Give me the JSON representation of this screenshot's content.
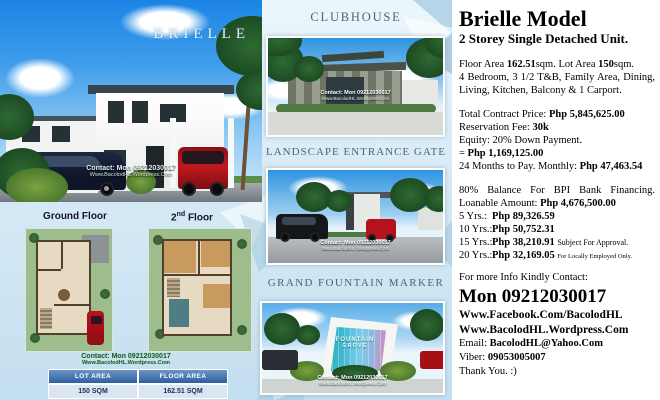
{
  "watermark": {
    "line1": "Contact: Mon 09212030017",
    "line2": "Www.BacolodHL.Wordpress.Com"
  },
  "hero": {
    "brand": "BRIELLE"
  },
  "floor_plans": {
    "ground_label": "Ground Floor",
    "second_num": "2",
    "second_sup": "nd",
    "second_rest": " Floor",
    "table": {
      "headers": [
        "LOT AREA",
        "FLOOR AREA"
      ],
      "values": [
        "150 SQM",
        "162.51 SQM"
      ]
    }
  },
  "amenities": {
    "clubhouse_title": "CLUBHOUSE",
    "gate_title": "LANDSCAPE ENTRANCE GATE",
    "fountain_title": "GRAND FOUNTAIN MARKER",
    "fountain_sign_line1": "FOUNTAIN",
    "fountain_sign_line2": "GROVE"
  },
  "details": {
    "title": "Brielle Model",
    "subtitle": "2 Storey Single Detached Unit.",
    "area_label1": "Floor Area ",
    "area_value1": "162.51",
    "area_label2": "sqm. Lot Area ",
    "area_value2": "150",
    "area_label3": "sqm.",
    "features_line1": "4 Bedroom, 3 1/2 T&B, Family Area, Dining,",
    "features_line2": "Living, Kitchen, Balcony & 1 Carport.",
    "tcp_label": "Total Contract Price: ",
    "tcp_value": "Php 5,845,625.00",
    "resv_label": "Reservation Fee: ",
    "resv_value": "30k",
    "equity_line": "Equity: 20% Down Payment.",
    "equity_prefix": "= ",
    "equity_value": "Php 1,169,125.00",
    "monthly_label": "24 Months to Pay. Monthly: ",
    "monthly_value": "Php 47,463.54",
    "balance_line": "80% Balance For BPI Bank Financing.",
    "loan_label": "Loanable Amount: ",
    "loan_value": "Php 4,676,500.00",
    "plans": [
      {
        "term": "5 Yrs.:",
        "amount": "Php 89,326.59",
        "note": ""
      },
      {
        "term": "10 Yrs.:",
        "amount": "Php 50,752.31",
        "note": ""
      },
      {
        "term": "15 Yrs.:",
        "amount": "Php 38,210.91",
        "note": "Subject For Approval."
      },
      {
        "term": "20 Yrs.:",
        "amount": "Php 32,169.05",
        "note": "For Locally Employed Only."
      }
    ],
    "contact_intro": "For more Info Kindly Contact:",
    "contact_main": "Mon 09212030017",
    "facebook": "Www.Facebook.Com/BacolodHL",
    "wordpress": "Www.BacolodHL.Wordpress.Com",
    "email_label": "Email: ",
    "email_value": "BacolodHL@Yahoo.Com",
    "viber_label": "Viber: ",
    "viber_value": "09053005007",
    "thanks": "Thank You. :)"
  },
  "colors": {
    "sky_blue": "#2a8fe0",
    "table_header_blue": "#2f5f9e",
    "table_row_blue": "#dce6f2",
    "amenity_title_gray": "#4f6374",
    "watermark_green": "#1c5a28",
    "accent_red": "#b5121b"
  }
}
